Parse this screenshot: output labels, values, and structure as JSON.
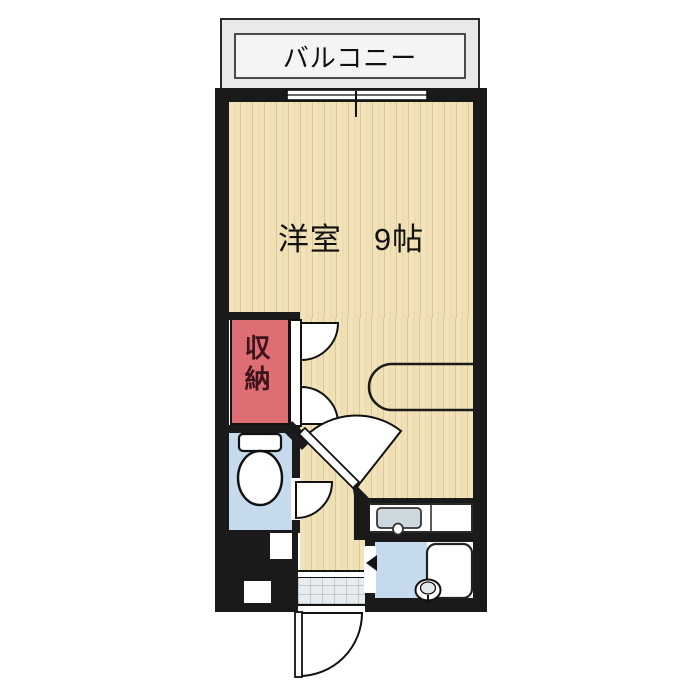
{
  "plan_type": "apartment-floor-plan",
  "labels": {
    "balcony": "バルコニー",
    "main_room": "洋室　9帖",
    "closet": "収納"
  },
  "rooms": [
    {
      "name": "balcony",
      "label": "バルコニー"
    },
    {
      "name": "western-room",
      "label": "洋室 9帖",
      "size_tatami": "9帖"
    },
    {
      "name": "closet",
      "label": "収納"
    },
    {
      "name": "toilet-room",
      "label": ""
    },
    {
      "name": "bathroom",
      "label": ""
    },
    {
      "name": "kitchen-area",
      "label": ""
    },
    {
      "name": "entrance",
      "label": ""
    }
  ],
  "elements": {
    "windows": [
      "balcony-sliding-window"
    ],
    "doors": [
      "entry-swing-door",
      "toilet-swing-door",
      "bathroom-door-marker",
      "room-diagonal-swing-door",
      "closet-double-doors"
    ],
    "fixtures": [
      "toilet",
      "bathtub",
      "washbasin",
      "kitchen-sink",
      "kitchen-counter",
      "wall-counter",
      "pipe-space-boxes",
      "entrance-tile",
      "entrance-step"
    ]
  },
  "colors": {
    "wall": "#1a1a1a",
    "wood_floor": "#f0e0b5",
    "wood_grain": "#ddc896",
    "closet_fill": "#df6e74",
    "closet_text": "#3d141b",
    "water_area_fill": "#c5daec",
    "balcony_fill": "#e9e9e9",
    "tile_fill": "#e9ecef",
    "sink_fill": "#ccd8dd",
    "background": "#ffffff"
  }
}
